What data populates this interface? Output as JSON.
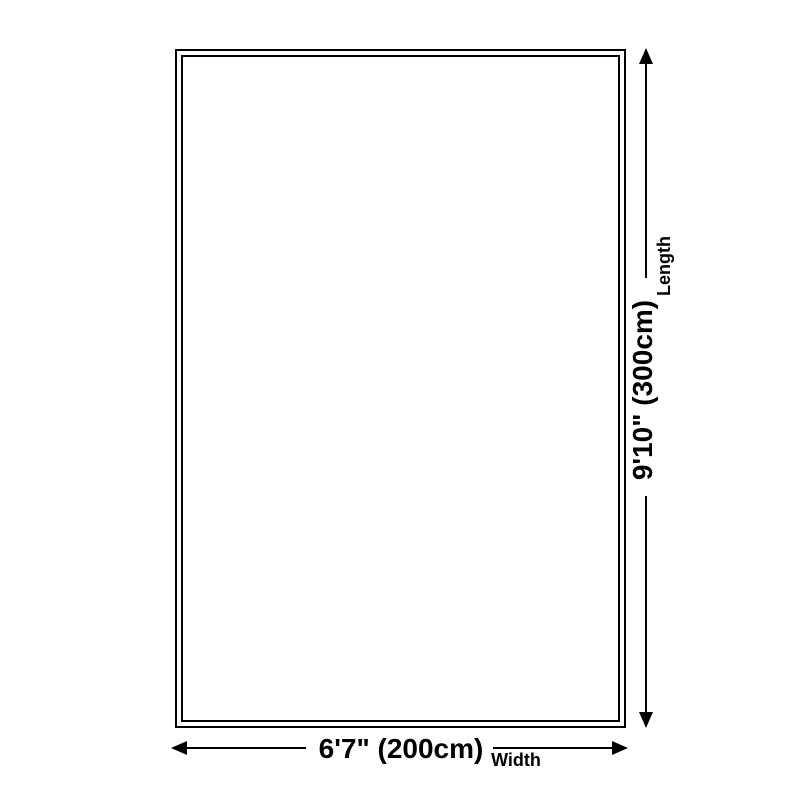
{
  "dimensions": {
    "length": {
      "label": "Length",
      "value": "9'10\" (300cm)"
    },
    "width": {
      "label": "Width",
      "value": "6'7\" (200cm)"
    }
  },
  "colors": {
    "line": "#000000",
    "background": "#ffffff"
  }
}
